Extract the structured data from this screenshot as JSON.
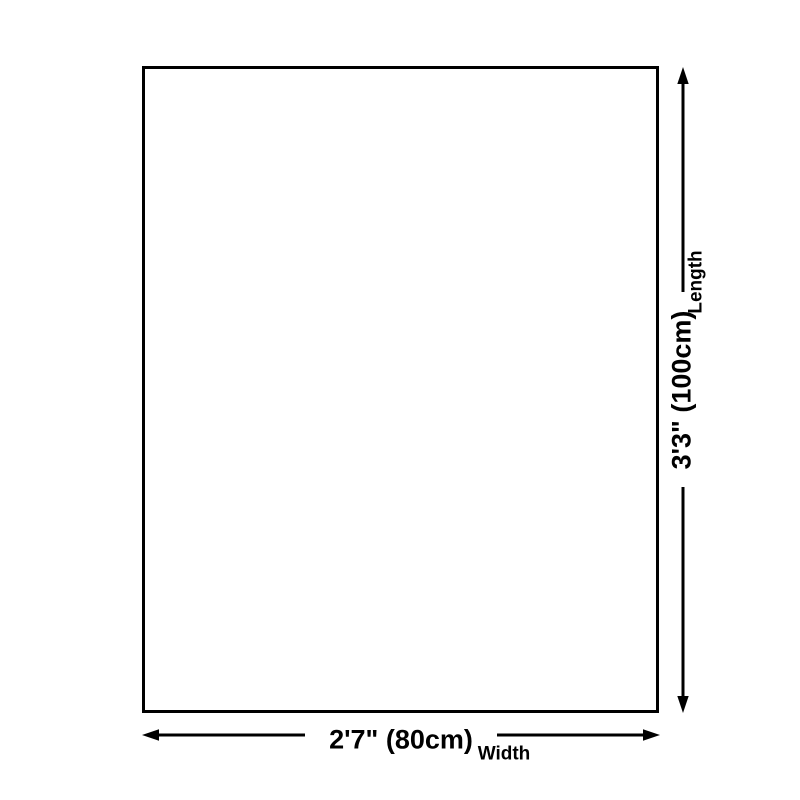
{
  "diagram": {
    "type": "product-dimension-diagram",
    "colors": {
      "ink": "#000000",
      "background": "#ffffff"
    },
    "length": {
      "value": "3'3\" (100cm)",
      "label": "Length",
      "orientation": "vertical"
    },
    "width": {
      "value": "2'7\" (80cm)",
      "label": "Width",
      "orientation": "horizontal"
    }
  }
}
